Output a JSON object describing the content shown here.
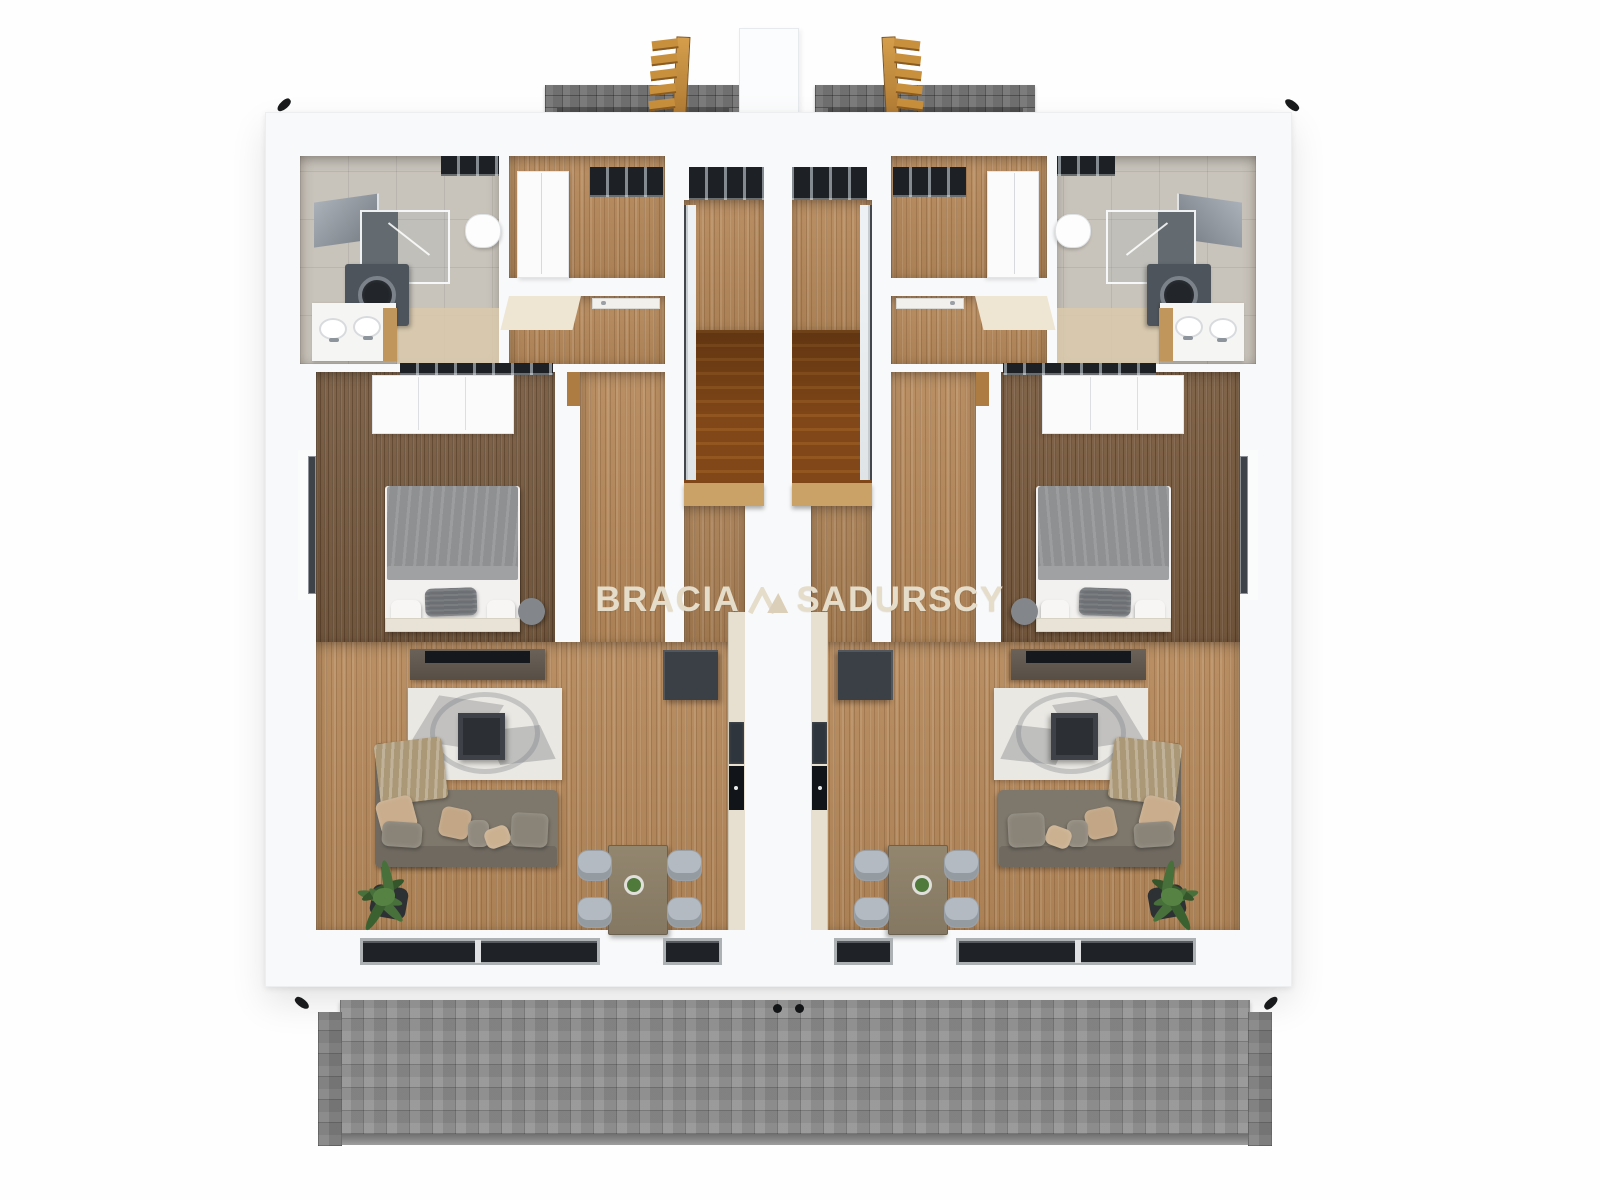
{
  "watermark": {
    "left": "BRACIA",
    "right": "SADURSCY",
    "mark": "mountain-logo-icon",
    "color": "#e5dcca"
  },
  "scene": {
    "type": "3d-floor-plan-top-down-render",
    "building": "semi-detached house upper floor, two mirrored units",
    "exterior": [
      "gray paved terrace top",
      "gray paved terrace bottom",
      "two wooden access ladders",
      "white roof column",
      "black corner brackets"
    ]
  },
  "unit_rooms": {
    "bathroom": [
      "shower glass cabin",
      "washing machine",
      "double sink counter",
      "mirror cabinet",
      "toilet",
      "skylight"
    ],
    "hall_top": [
      "white wardrobe",
      "window band"
    ],
    "hall_bottom": [
      "door leaf"
    ],
    "staircase": [
      "window band",
      "upper landing",
      "wooden stair flight",
      "railing"
    ],
    "bedroom": [
      "double bed",
      "gray duvet",
      "dark pillow",
      "headboard",
      "white wardrobe band",
      "round pouf",
      "side window"
    ],
    "living_room": [
      "tv console",
      "tv",
      "abstract rug",
      "coffee table",
      "corner sofa",
      "beige throw",
      "pillows",
      "potted plant"
    ],
    "kitchen": [
      "fridge cabinet",
      "counter strip",
      "cooktop",
      "oven",
      "dining table",
      "table plant",
      "4 chairs"
    ],
    "south_wall": [
      "large window",
      "small window"
    ]
  },
  "palette": {
    "background": "#fefefe",
    "slab_white": "#f8f9fa",
    "wood_light": "#b5885a",
    "wood_dark": "#7b5d41",
    "bath_tile": "#c8c3bb",
    "bath_tile_beige": "#d9c9ac",
    "paving_gray": "#8f8f8f",
    "brick_gray": "#747474",
    "window_dark": "#1f2328",
    "appliance_dark": "#3a4046",
    "sofa_gray": "#7e776b",
    "pillow_beige": "#c9ad8c",
    "throw_tan": "#ab9877",
    "chair_gray": "#b4bac1",
    "ladder_wood": "#c8903c",
    "plant_green": "#47703a",
    "watermark_text": "#e5dcca"
  }
}
